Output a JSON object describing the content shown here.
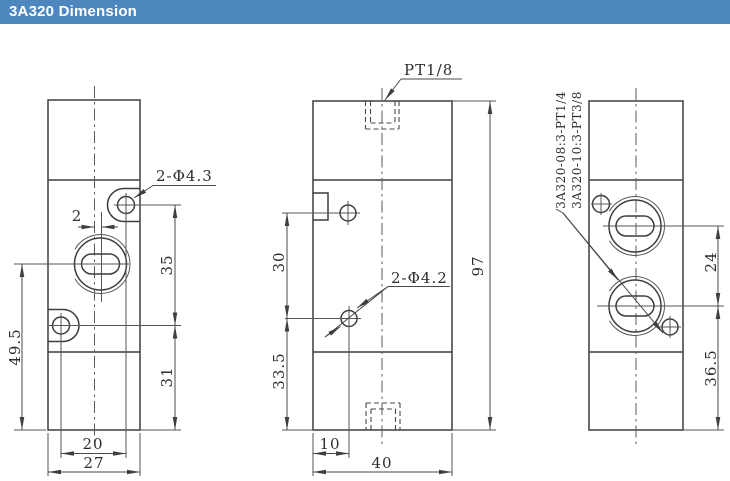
{
  "header": {
    "title": "3A320 Dimension"
  },
  "colors": {
    "header_bg": "#4d87bd",
    "header_fg": "#ffffff",
    "page_bg": "#ffffff",
    "line": "#3d3d3d",
    "dim_line": "#4a4a4a",
    "text": "#2d2d2d"
  },
  "views": {
    "front": {
      "callout_holes": "2-Φ4.3",
      "dims": {
        "center_offset": "2",
        "hole_span_vertical": "35",
        "lower_section": "31",
        "port_center_height": "49.5",
        "hole_span_horizontal": "20",
        "width": "27"
      }
    },
    "side": {
      "top_port": "PT1/8",
      "callout_holes": "2-Φ4.2",
      "dims": {
        "upper_hole": "30",
        "lower_hole": "33.5",
        "height": "97",
        "hole_offset": "10",
        "depth": "40"
      }
    },
    "back": {
      "variants": [
        "3A320-08:3-PT1/4",
        "3A320-10:3-PT3/8"
      ],
      "dims": {
        "port_span": "24",
        "lower_port": "36.5"
      }
    }
  }
}
